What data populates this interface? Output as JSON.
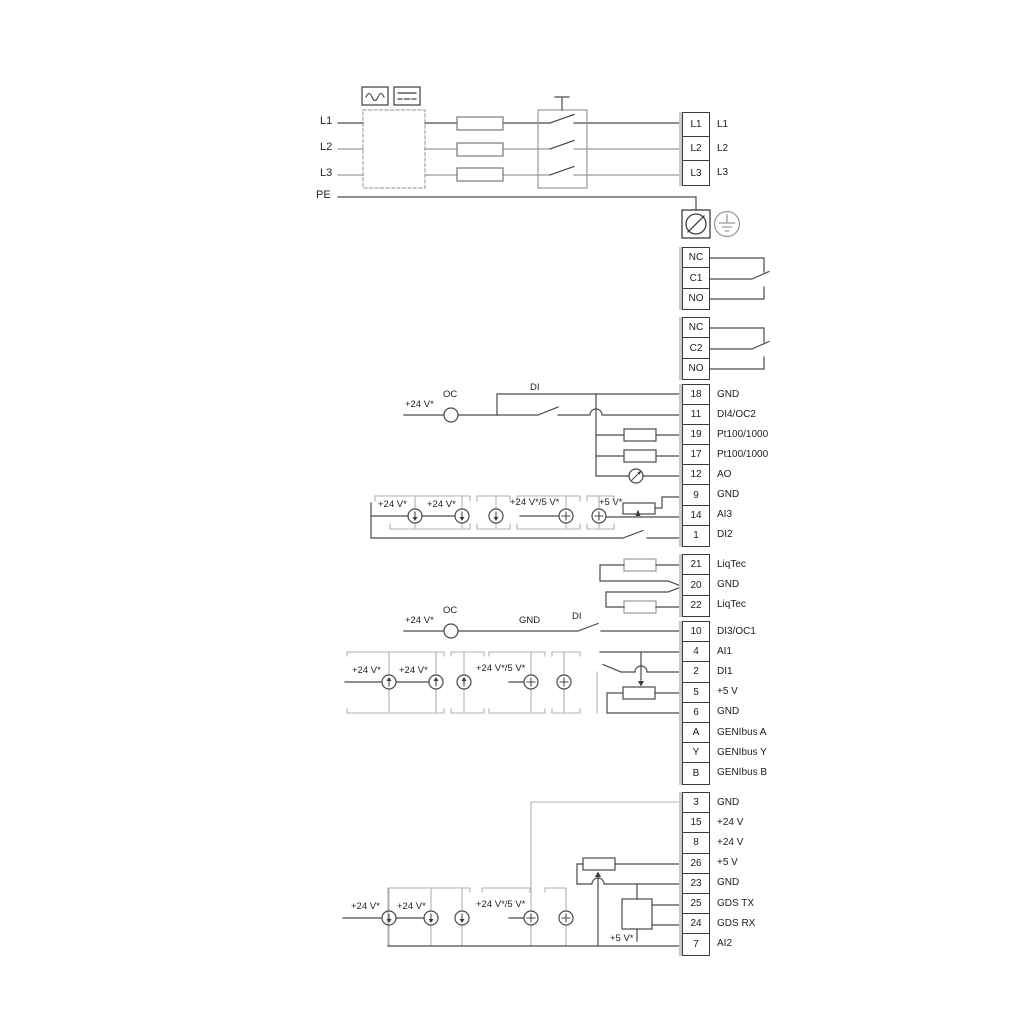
{
  "power": {
    "left_labels": [
      "L1",
      "L2",
      "L3",
      "PE"
    ],
    "output_terminals": [
      "L1",
      "L2",
      "L3"
    ]
  },
  "relays": {
    "relay1": [
      "NC",
      "C1",
      "NO"
    ],
    "relay2": [
      "NC",
      "C2",
      "NO"
    ]
  },
  "strips": {
    "io1": [
      [
        "18",
        "GND"
      ],
      [
        "11",
        "DI4/OC2"
      ],
      [
        "19",
        "Pt100/1000"
      ],
      [
        "17",
        "Pt100/1000"
      ],
      [
        "12",
        "AO"
      ],
      [
        "9",
        "GND"
      ],
      [
        "14",
        "AI3"
      ],
      [
        "1",
        "DI2"
      ]
    ],
    "liqtec": [
      [
        "21",
        "LiqTec"
      ],
      [
        "20",
        "GND"
      ],
      [
        "22",
        "LiqTec"
      ]
    ],
    "io2": [
      [
        "10",
        "DI3/OC1"
      ],
      [
        "4",
        "AI1"
      ],
      [
        "2",
        "DI1"
      ],
      [
        "5",
        "+5 V"
      ],
      [
        "6",
        "GND"
      ],
      [
        "A",
        "GENIbus A"
      ],
      [
        "Y",
        "GENIbus Y"
      ],
      [
        "B",
        "GENIbus B"
      ]
    ],
    "io3": [
      [
        "3",
        "GND"
      ],
      [
        "15",
        "+24 V"
      ],
      [
        "8",
        "+24 V"
      ],
      [
        "26",
        "+5 V"
      ],
      [
        "23",
        "GND"
      ],
      [
        "25",
        "GDS TX"
      ],
      [
        "24",
        "GDS RX"
      ],
      [
        "7",
        "AI2"
      ]
    ]
  },
  "labels": {
    "v24": "+24 V*",
    "v24v5": "+24 V*/5 V*",
    "v5": "+5 V*",
    "oc": "OC",
    "di": "DI",
    "gnd": "GND"
  }
}
